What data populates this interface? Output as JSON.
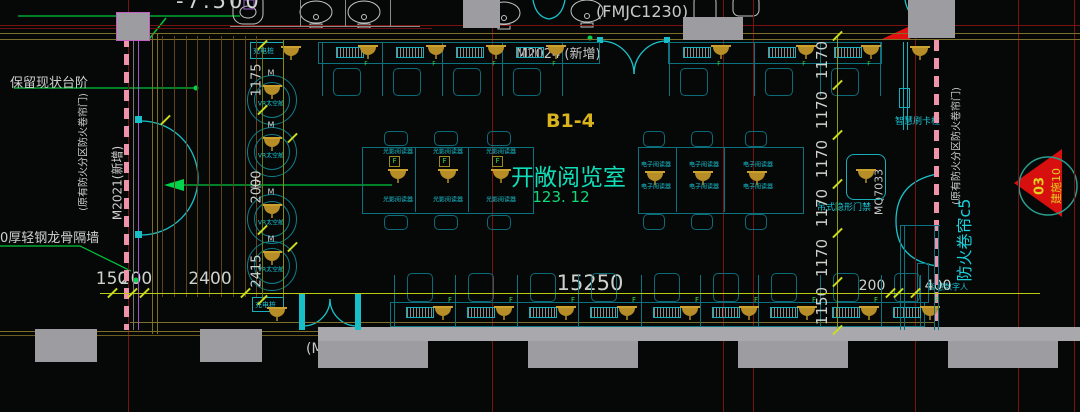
{
  "colors": {
    "background": "#060807",
    "pink_fire_shutter": "#ef93ab",
    "cad_cyan": "#17c0c8",
    "lamp_gold": "#c69b2f",
    "dim_yellow": "#b9cb16",
    "grid_red": "#7a1212",
    "leader_green": "#00c83c",
    "text_white": "#cfcfcf",
    "room_name_green": "#0fdfb9",
    "room_code_yellow": "#d9b41c",
    "area_green": "#13d878",
    "column_gray": "#9d9da1",
    "callout_red": "#d80f0f",
    "callout_text_yellow": "#e3cf1d"
  },
  "top": {
    "elevation_text": "-7.500",
    "fmjc_label": "(FMJC1230)",
    "m2024_label": "M2024 (新增)"
  },
  "left": {
    "keep_steps_label": "保留现状台阶",
    "partition_wall_label": "0厚轻钢龙骨隔墙",
    "m2021_label": "M2021(新增)",
    "fire_shutter_note": "(原有防火分区防火卷帘门)",
    "stairs_up_label": "上",
    "vr_pod_label": "VR太空舱",
    "pod_tag": "M",
    "dims_vertical": [
      "1175",
      "2000",
      "2415"
    ]
  },
  "room": {
    "code": "B1-4",
    "name": "开敞阅览室",
    "area": "123. 12",
    "optical_reader_label": "光影阅读器",
    "ebook_reader_label": "电子阅读器",
    "lamp_tag": "F",
    "charging_label": "充电桩"
  },
  "bottom": {
    "door_label": "(M1524)",
    "dims": [
      "150",
      "200",
      "2400",
      "15250",
      "200",
      "400"
    ],
    "smart_human_label": "智慧数字人"
  },
  "right": {
    "card_post_label": "智慧刷卡柱",
    "door_sensor_label": "吊式隐形门禁",
    "door_code": "MQ7033",
    "fire_curtain_label": "防火卷帘c5",
    "fire_shutter_note": "(原有防火分区防火卷帘门)",
    "dims_vertical": [
      "1170",
      "1170",
      "1170",
      "1170",
      "1170",
      "1150"
    ],
    "callout_number": "03",
    "callout_sheet": "建施10"
  }
}
